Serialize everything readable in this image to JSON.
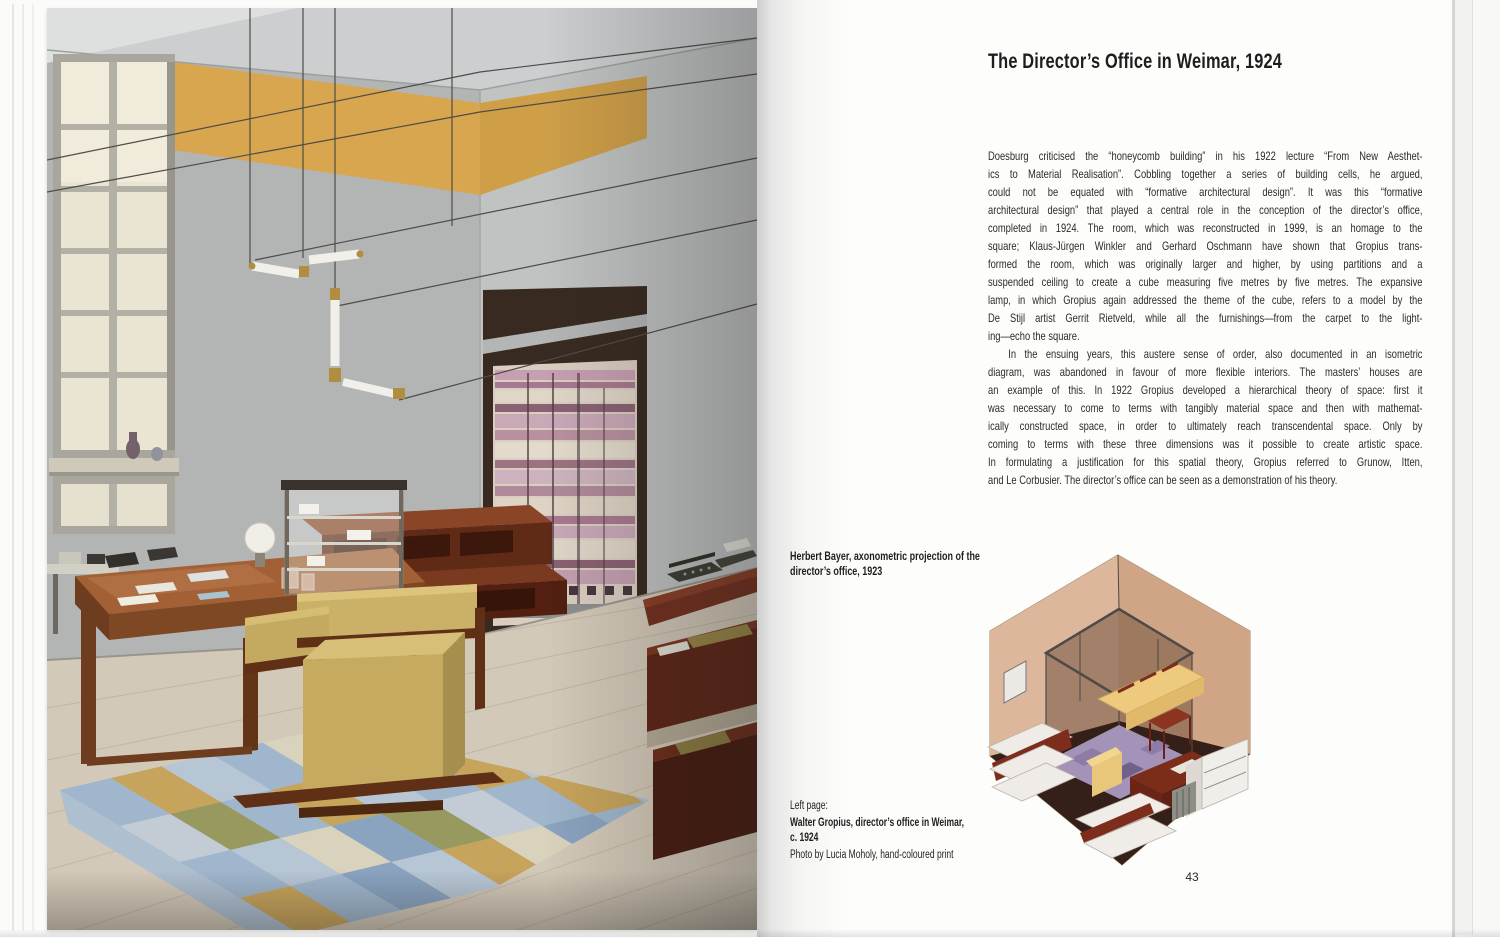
{
  "right_page": {
    "title": "The Director’s Office in Weimar, 1924",
    "body": [
      {
        "lines": [
          "Doesburg criticised the “honeycomb building” in his 1922 lecture “From New Aesthet-",
          "ics to Material Realisation”. Cobbling together a series of building cells, he argued,",
          "could not be equated with “formative architectural design”. It was this “formative",
          "architectural design” that played a central role in the conception of the director’s office,",
          "completed in 1924. The room, which was reconstructed in 1999, is an homage to the",
          "square; Klaus-Jürgen Winkler and Gerhard Oschmann have shown that Gropius trans-",
          "formed the room, which was originally larger and higher, by using partitions and a",
          "suspended ceiling to create a cube measuring five metres by five metres. The expansive",
          "lamp, in which Gropius again addressed the theme of the cube, refers to a model by the",
          "De Stijl artist Gerrit Rietveld, while all the furnishings—from the carpet to the light-",
          "ing—echo the square."
        ]
      },
      {
        "lines": [
          "In the ensuing years, this austere sense of order, also documented in an isometric",
          "diagram, was abandoned in favour of more flexible interiors. The masters’ houses are",
          "an example of this. In 1922 Gropius developed a hierarchical theory of space: first it",
          "was necessary to come to terms with tangibly material space and then with mathemat-",
          "ically constructed space, in order to ultimately reach transcendental space. Only by",
          "coming to terms with these three dimensions was it possible to create artistic space.",
          "In formulating a justification for this spatial theory, Gropius referred to Grunow, Itten,",
          "and Le Corbusier. The director’s office can be seen as a demonstration of his theory."
        ]
      }
    ],
    "figure_caption": {
      "lines": [
        "Herbert Bayer, axonometric projection of the",
        "director’s office, 1923"
      ]
    },
    "photo_caption": {
      "intro": "Left page:",
      "lines": [
        "Walter Gropius, director’s office in Weimar,",
        "c. 1924"
      ],
      "credit": "Photo by Lucia Moholy, hand-coloured print"
    },
    "page_number": "43"
  },
  "colors": {
    "accent_yellow": "#d7a64e",
    "wall_grey": "#b6b8b8",
    "carpet_purple": "#a393b8",
    "sofa_yellow": "#eeca7e",
    "furniture_red": "#7c2d1a",
    "rug_blue": "#9fb6cd",
    "text": "#2b2b2b",
    "page_background": "#fdfdfc"
  }
}
